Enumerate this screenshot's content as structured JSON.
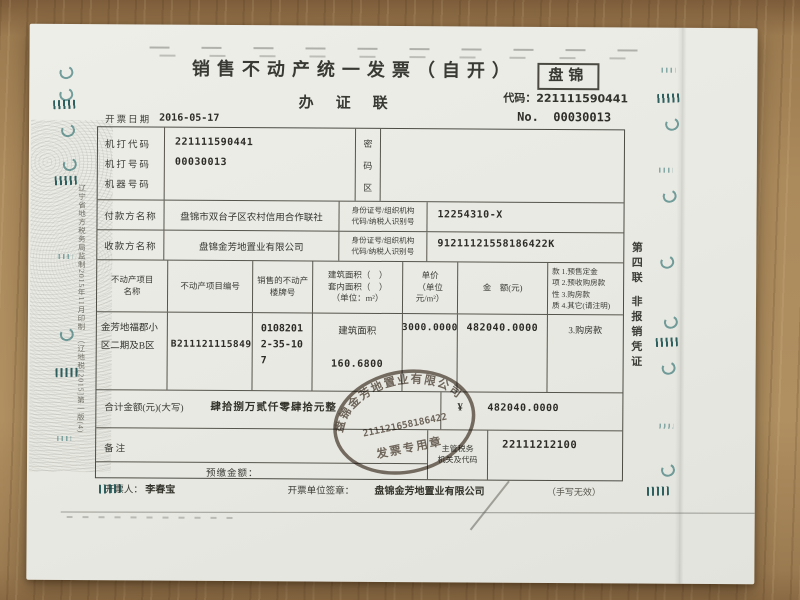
{
  "header": {
    "title": "销售不动产统一发票（自开）",
    "region_stamp": "盘锦",
    "code_label": "代码：",
    "code_value": "221111590441",
    "copy_label": "办证联",
    "number_label": "No.",
    "number_value": "00030013",
    "date_label": "开票日期",
    "date_value": "2016-05-17"
  },
  "machine_block": {
    "code_label": "机打代码",
    "number_label": "机打号码",
    "device_label": "机器号码",
    "code_value": "221111590441",
    "number_value": "00030013",
    "password_chars": [
      "密",
      "码",
      "区"
    ]
  },
  "parties": [
    {
      "label": "付款方名称",
      "name": "盘锦市双台子区农村信用合作联社",
      "id_label_1": "身份证号/组织机构",
      "id_label_2": "代码/纳税人识别号",
      "id_value": "12254310-X"
    },
    {
      "label": "收款方名称",
      "name": "盘锦金芳地置业有限公司",
      "id_label_1": "身份证号/组织机构",
      "id_label_2": "代码/纳税人识别号",
      "id_value": "91211121558186422K"
    }
  ],
  "property": {
    "headers": {
      "name_1": "不动产项目",
      "name_2": "名称",
      "project_no": "不动产项目编号",
      "address_1": "销售的不动产",
      "address_2": "楼牌号",
      "area_1": "建筑面积（　）",
      "area_2": "套内面积（　）",
      "area_3": "（单位：m²）",
      "price_1": "单价",
      "price_2": "（单位",
      "price_3": "元/m²）",
      "amount": "金　额(元)",
      "nature_lines": [
        "款 1.预售定金",
        "项 2.预收购房款",
        "性 3.购房款",
        "质 4.其它(请注明)"
      ]
    },
    "row": {
      "name_1": "金芳地福郡小",
      "name_2": "区二期及B区",
      "project_no": "B21112111584904",
      "address_1": "0108201",
      "address_2": "2-35-10",
      "address_3": "7",
      "area_type": "建筑面积",
      "area_value": "160.6800",
      "unit_price": "3000.0000",
      "amount": "482040.0000",
      "nature": "3.购房款"
    }
  },
  "total": {
    "label": "合计金额(元)(大写)",
    "uppercase": "肆拾捌万贰仟零肆拾元整",
    "currency": "¥",
    "value": "482040.0000"
  },
  "remark_label": "备注",
  "prepaid_label": "预缴金额：",
  "tax_authority": {
    "label_1": "主管税务",
    "label_2": "机关及代码",
    "value": "22111212100"
  },
  "footer": {
    "issuer_label": "开票人：",
    "issuer": "李春宝",
    "unit_label": "开票单位签章：",
    "unit": "盘锦金芳地置业有限公司",
    "note": "（手写无效）"
  },
  "stamp": {
    "company": "盘锦金芳地置业有限公司",
    "number": "211121658186422",
    "caption": "发票专用章"
  },
  "side_notes": {
    "left": "辽宁省地方税务局监制2015年11月印制　（辽地税[2015]第一版(4)",
    "right_1": "第四联",
    "right_2": "非报销凭证"
  },
  "colors": {
    "carbon_teal": "#1e6868",
    "print_gray": "#3a3a34",
    "paper": "#e9e9e3"
  }
}
